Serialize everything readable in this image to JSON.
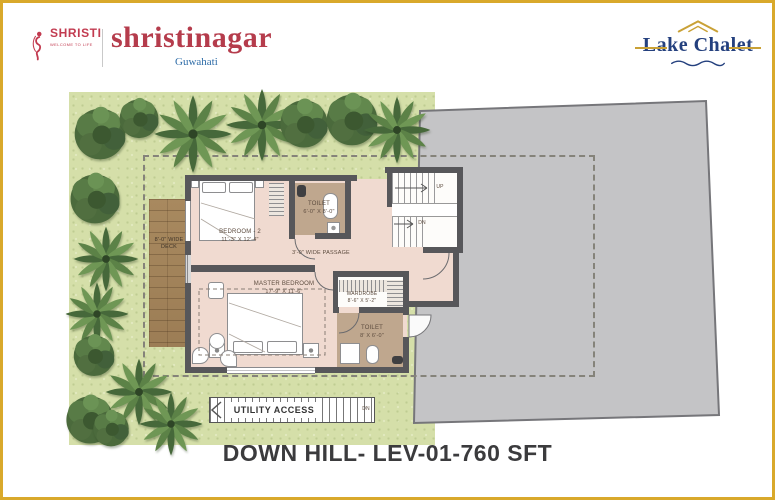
{
  "header": {
    "shristi": {
      "name": "SHRISTI",
      "tagline": "WELCOME TO LIFE"
    },
    "project": {
      "name": "shristinagar",
      "city": "Guwahati"
    },
    "brand": {
      "name": "Lake Chalet"
    }
  },
  "plan": {
    "deck": {
      "line1": "8'-0\" WIDE",
      "line2": "DECK"
    },
    "bedroom2": {
      "name": "BEDROOM - 2",
      "dims": "11'-3\" X 12'-4\""
    },
    "toilet_top": {
      "name": "TOILET",
      "dims": "6'-0\" X 8'-0\""
    },
    "stairs": {
      "up": "UP",
      "down": "DN"
    },
    "passage": {
      "label": "3'-0\" WIDE PASSAGE"
    },
    "master_bedroom": {
      "name": "MASTER BEDROOM",
      "dims": "17'-9\" X 11'-6\""
    },
    "wardrobe": {
      "name": "WARDROBE",
      "dims": "8'-6\" X 5'-2\""
    },
    "toilet_bottom": {
      "name": "TOILET",
      "dims": "8' X 6'-0\""
    },
    "utility": {
      "label": "UTILITY ACCESS",
      "down": "DN"
    }
  },
  "footer": {
    "title": "DOWN HILL- LEV-01-760 SFT"
  },
  "colors": {
    "border_gold": "#D9A92B",
    "brand_navy": "#24407E",
    "shristi_red": "#C23B50",
    "guwahati_blue": "#2F6DA8",
    "roof_gray": "#C4C4C6",
    "floor_pink": "#F0DAD0",
    "toilet_taupe": "#BFA78E",
    "grass_green": "#D5DFA9",
    "wall_gray": "#57575A",
    "deck_wood": "#A8895F"
  }
}
